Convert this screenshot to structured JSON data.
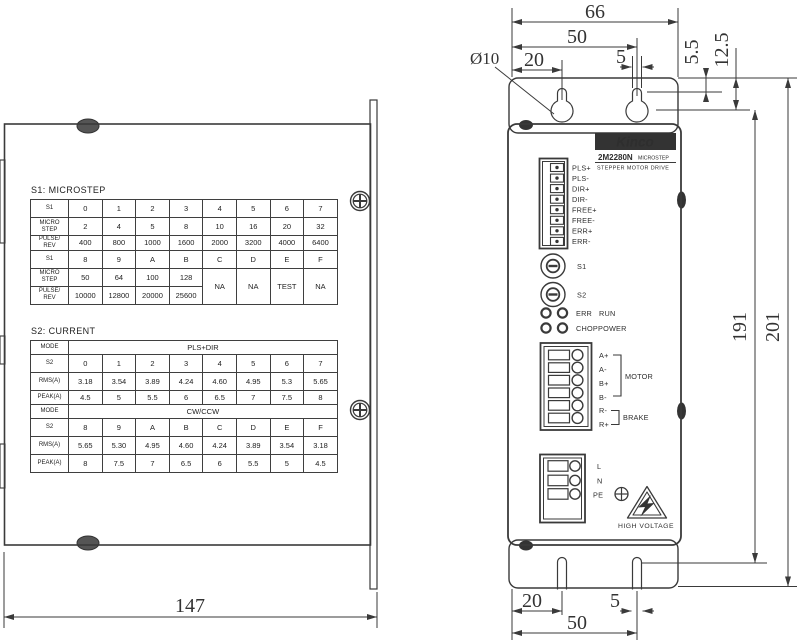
{
  "tables": {
    "microstep": {
      "title": "S1: MICROSTEP",
      "rows": [
        [
          {
            "t": "S1",
            "hd": 1
          },
          "0",
          "1",
          "2",
          "3",
          "4",
          "5",
          "6",
          "7"
        ],
        [
          {
            "t": "MICRO\nSTEP",
            "hd": 1
          },
          "2",
          "4",
          "5",
          "8",
          "10",
          "16",
          "20",
          "32"
        ],
        [
          {
            "t": "PULSE/\nREV",
            "hd": 1
          },
          "400",
          "800",
          "1000",
          "1600",
          "2000",
          "3200",
          "4000",
          "6400"
        ],
        [
          {
            "t": "S1",
            "hd": 1
          },
          "8",
          "9",
          "A",
          "B",
          "C",
          "D",
          "E",
          "F"
        ],
        [
          {
            "t": "MICRO\nSTEP",
            "hd": 1
          },
          "50",
          "64",
          "100",
          "128",
          {
            "t": "NA",
            "rs": 2
          },
          {
            "t": "NA",
            "rs": 2
          },
          {
            "t": "TEST",
            "rs": 2
          },
          {
            "t": "NA",
            "rs": 2
          }
        ],
        [
          {
            "t": "PULSE/\nREV",
            "hd": 1
          },
          "10000",
          "12800",
          "20000",
          "25600"
        ]
      ]
    },
    "current": {
      "title": "S2: CURRENT",
      "rows": [
        [
          {
            "t": "MODE",
            "hd": 1
          },
          {
            "t": "PLS+DIR",
            "cs": 8
          }
        ],
        [
          {
            "t": "S2",
            "hd": 1
          },
          "0",
          "1",
          "2",
          "3",
          "4",
          "5",
          "6",
          "7"
        ],
        [
          {
            "t": "RMS(A)",
            "hd": 1
          },
          "3.18",
          "3.54",
          "3.89",
          "4.24",
          "4.60",
          "4.95",
          "5.3",
          "5.65"
        ],
        [
          {
            "t": "PEAK(A)",
            "hd": 1
          },
          "4.5",
          "5",
          "5.5",
          "6",
          "6.5",
          "7",
          "7.5",
          "8"
        ],
        [
          {
            "t": "MODE",
            "hd": 1
          },
          {
            "t": "CW/CCW",
            "cs": 8
          }
        ],
        [
          {
            "t": "S2",
            "hd": 1
          },
          "8",
          "9",
          "A",
          "B",
          "C",
          "D",
          "E",
          "F"
        ],
        [
          {
            "t": "RMS(A)",
            "hd": 1
          },
          "5.65",
          "5.30",
          "4.95",
          "4.60",
          "4.24",
          "3.89",
          "3.54",
          "3.18"
        ],
        [
          {
            "t": "PEAK(A)",
            "hd": 1
          },
          "8",
          "7.5",
          "7",
          "6.5",
          "6",
          "5.5",
          "5",
          "4.5"
        ]
      ]
    }
  },
  "front": {
    "brand": "Kinco",
    "model": "2M2280N",
    "model_tag": "MICROSTEP",
    "subtitle": "STEPPER MOTOR DRIVE",
    "signal_pins": [
      "PLS+",
      "PLS-",
      "DIR+",
      "DIR-",
      "FREE+",
      "FREE-",
      "ERR+",
      "ERR-"
    ],
    "switch_labels": [
      "S1",
      "S2"
    ],
    "led_labels": [
      "ERR",
      "RUN",
      "CHOP",
      "POWER"
    ],
    "motor_pins": [
      "A+",
      "A-",
      "B+",
      "B-",
      "R-",
      "R+"
    ],
    "motor_group": "MOTOR",
    "brake_group": "BRAKE",
    "power_pins": [
      "L",
      "N",
      "PE"
    ],
    "warning": "HIGH VOLTAGE"
  },
  "dims": {
    "w66": "66",
    "w50": "50",
    "w20": "20",
    "w5": "5",
    "dia": "Ø10",
    "off55": "5.5",
    "off125": "12.5",
    "h191": "191",
    "h201": "201",
    "b20": "20",
    "b5": "5",
    "b50": "50",
    "d147": "147"
  },
  "colors": {
    "line": "#3a3a3a",
    "dark": "#333333"
  }
}
